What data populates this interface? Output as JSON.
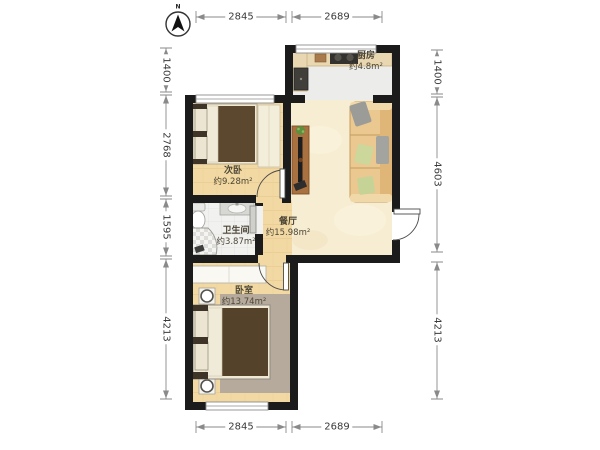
{
  "compass": {
    "label": "N"
  },
  "rooms": {
    "kitchen": {
      "name": "厨房",
      "area": "约4.8m²"
    },
    "second_bedroom": {
      "name": "次卧",
      "area": "约9.28m²"
    },
    "dining": {
      "name": "餐厅",
      "area": "约15.98m²"
    },
    "bathroom": {
      "name": "卫生间",
      "area": "约3.87m²"
    },
    "master_bedroom": {
      "name": "卧室",
      "area": "约13.74m²"
    }
  },
  "dimensions": {
    "top": [
      "2845",
      "2689"
    ],
    "bottom": [
      "2845",
      "2689"
    ],
    "left": [
      "1400",
      "2768",
      "1595",
      "4213"
    ],
    "right": [
      "1400",
      "4603",
      "4213"
    ]
  },
  "colors": {
    "wall": "#1b1b1b",
    "wood_floor": "#f2d9a3",
    "marble_floor": "#f7edd3",
    "tile_floor": "#efefed",
    "sofa": "#eac88f",
    "blanket": "#5c482e"
  }
}
